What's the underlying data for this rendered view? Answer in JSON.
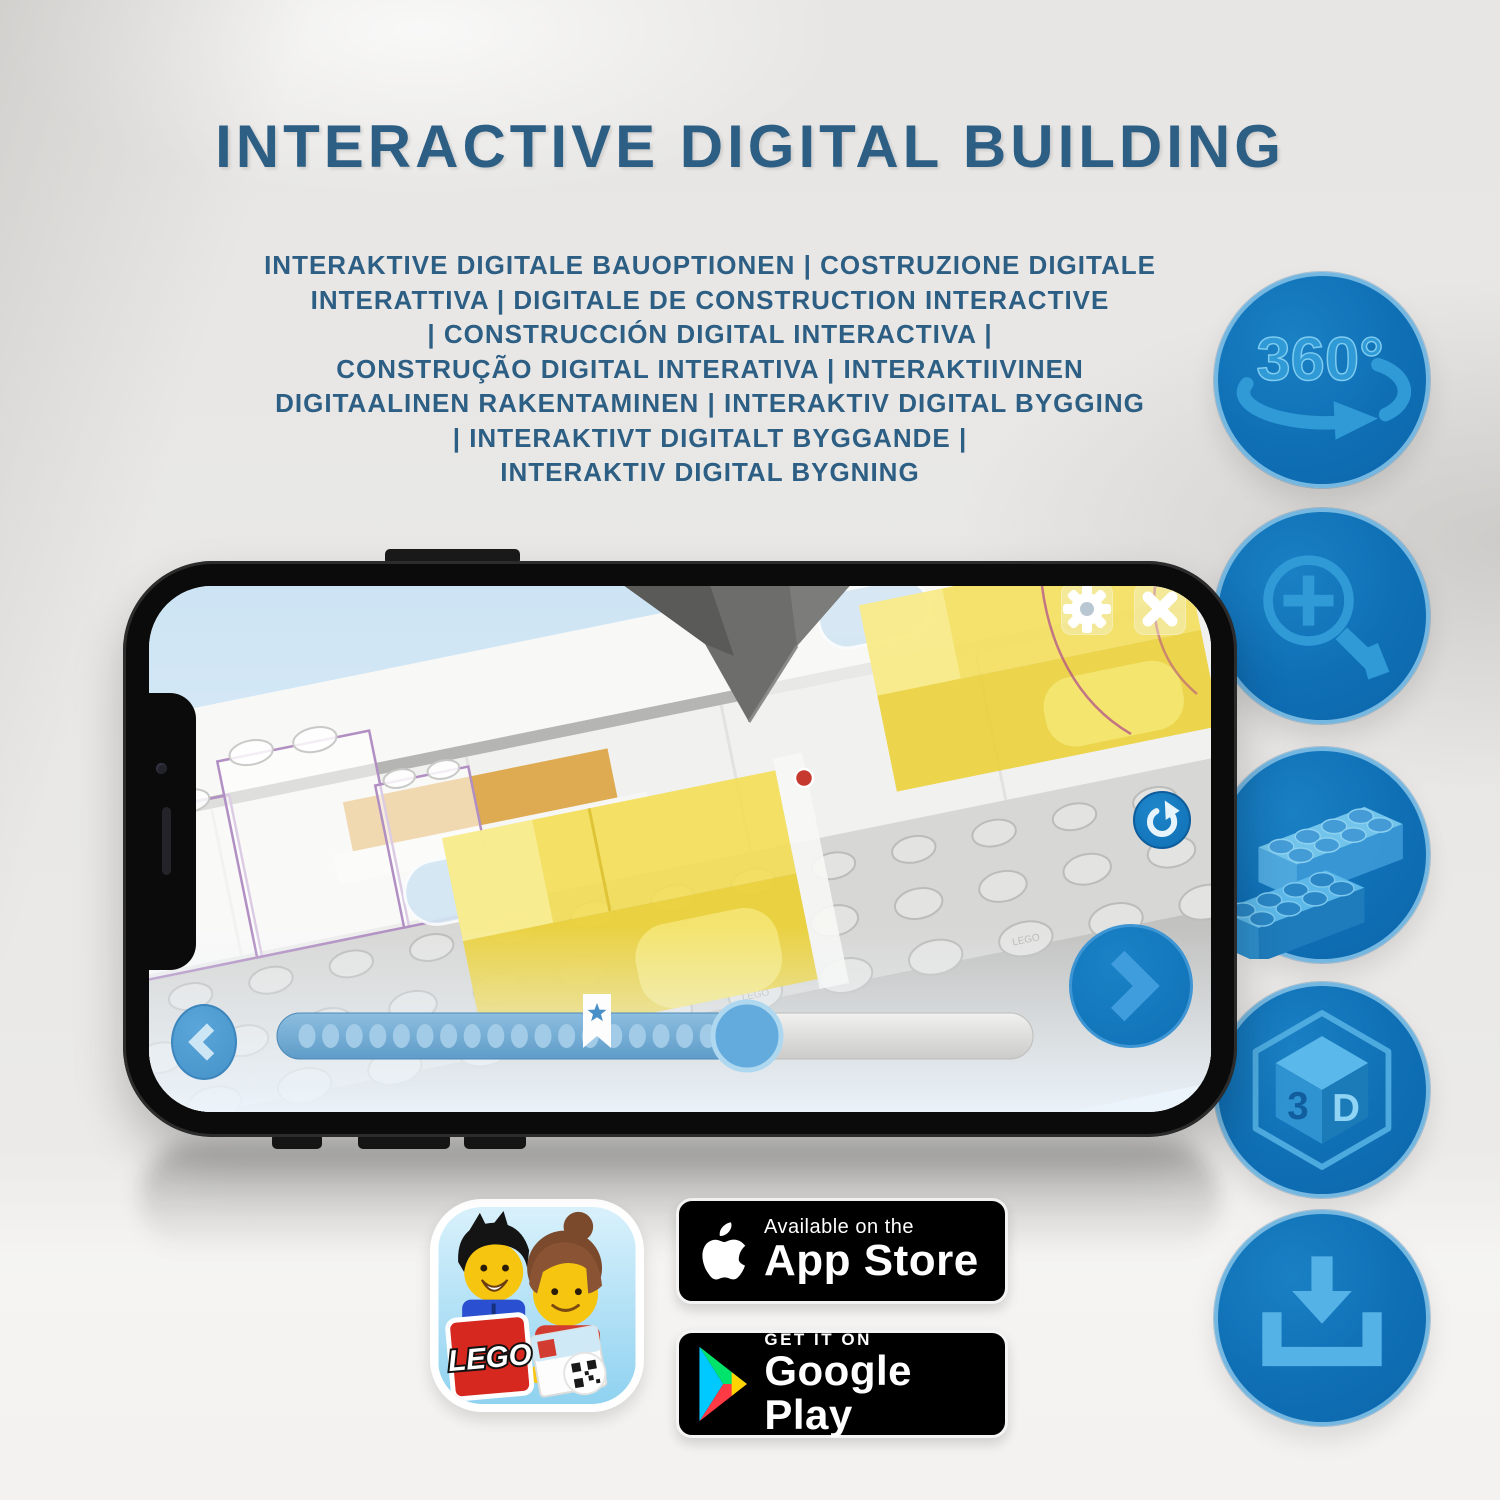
{
  "title": "INTERACTIVE DIGITAL BUILDING",
  "subtitle_lines": [
    "INTERAKTIVE DIGITALE BAUOPTIONEN | COSTRUZIONE DIGITALE",
    "INTERATTIVA | DIGITALE DE CONSTRUCTION INTERACTIVE",
    "| CONSTRUCCIÓN DIGITAL INTERACTIVA |",
    "CONSTRUÇÃO DIGITAL INTERATIVA | INTERAKTIIVINEN",
    "DIGITAALINEN RAKENTAMINEN | INTERAKTIV DIGITAL BYGGING",
    "| INTERAKTIVT DIGITALT BYGGANDE |",
    "INTERAKTIV DIGITAL BYGNING"
  ],
  "feature_icons": [
    {
      "name": "rotate-360-icon",
      "label": "360°"
    },
    {
      "name": "zoom-in-icon"
    },
    {
      "name": "brick-icon"
    },
    {
      "name": "3d-view-icon",
      "label_left": "3",
      "label_right": "D"
    },
    {
      "name": "download-icon"
    }
  ],
  "phone": {
    "screen_ui": {
      "top_buttons": [
        "settings-gear",
        "close"
      ],
      "progress": {
        "filled_percent": 57,
        "bookmark_percent": 42,
        "dot_count": 19
      },
      "stud_emboss_text": "LEGO"
    }
  },
  "app_badges": {
    "app_store": {
      "line1": "Available on the",
      "line2": "App Store"
    },
    "google_play": {
      "line1": "GET IT ON",
      "line2": "Google Play"
    }
  },
  "app_icon": {
    "logo_text": "LEGO"
  },
  "colors": {
    "headline": "#2d5e84",
    "icon_circle": "#0f72b8",
    "icon_ring": "#74b7e0",
    "icon_glyph": "#2f9ad6",
    "screen_sky": "#cde4f4",
    "bed_yellow": "#f3de55",
    "progress_blue": "#6ea6cf",
    "lego_logo_red": "#d6281e"
  }
}
